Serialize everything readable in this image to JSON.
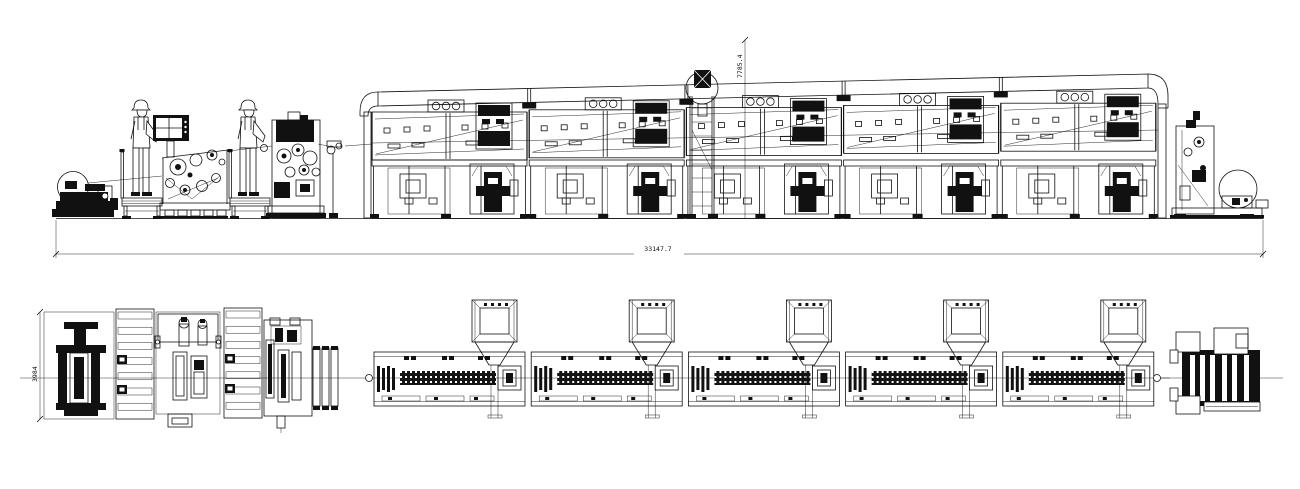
{
  "drawing": {
    "dimensions": {
      "total_length": "33147.7",
      "height": "7785.4",
      "width": "3984"
    },
    "counts": {
      "oven_modules": 5,
      "exhaust_hoods": 5,
      "operators": 2
    },
    "colors": {
      "line": "#111111",
      "background": "#ffffff"
    }
  }
}
